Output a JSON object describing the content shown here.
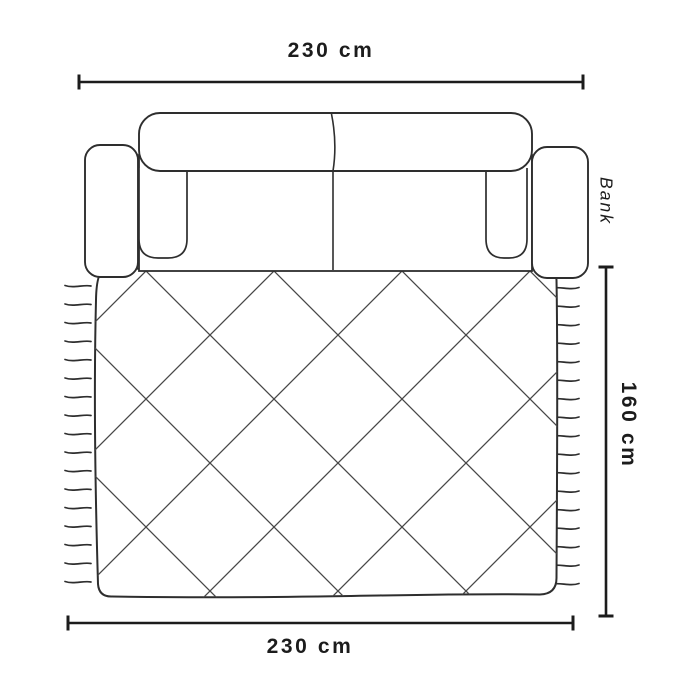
{
  "diagram": {
    "kind": "sofa-and-rug-top-view-dimension-diagram",
    "item_label": "Bank",
    "dimensions": {
      "top_width": "230 cm",
      "bottom_width": "230 cm",
      "right_depth": "160 cm"
    },
    "colors": {
      "background": "#ffffff",
      "outline": "#2e2e2e",
      "lattice": "#474747",
      "dimension_line": "#1c1c1c",
      "text": "#1c1c1c"
    }
  }
}
